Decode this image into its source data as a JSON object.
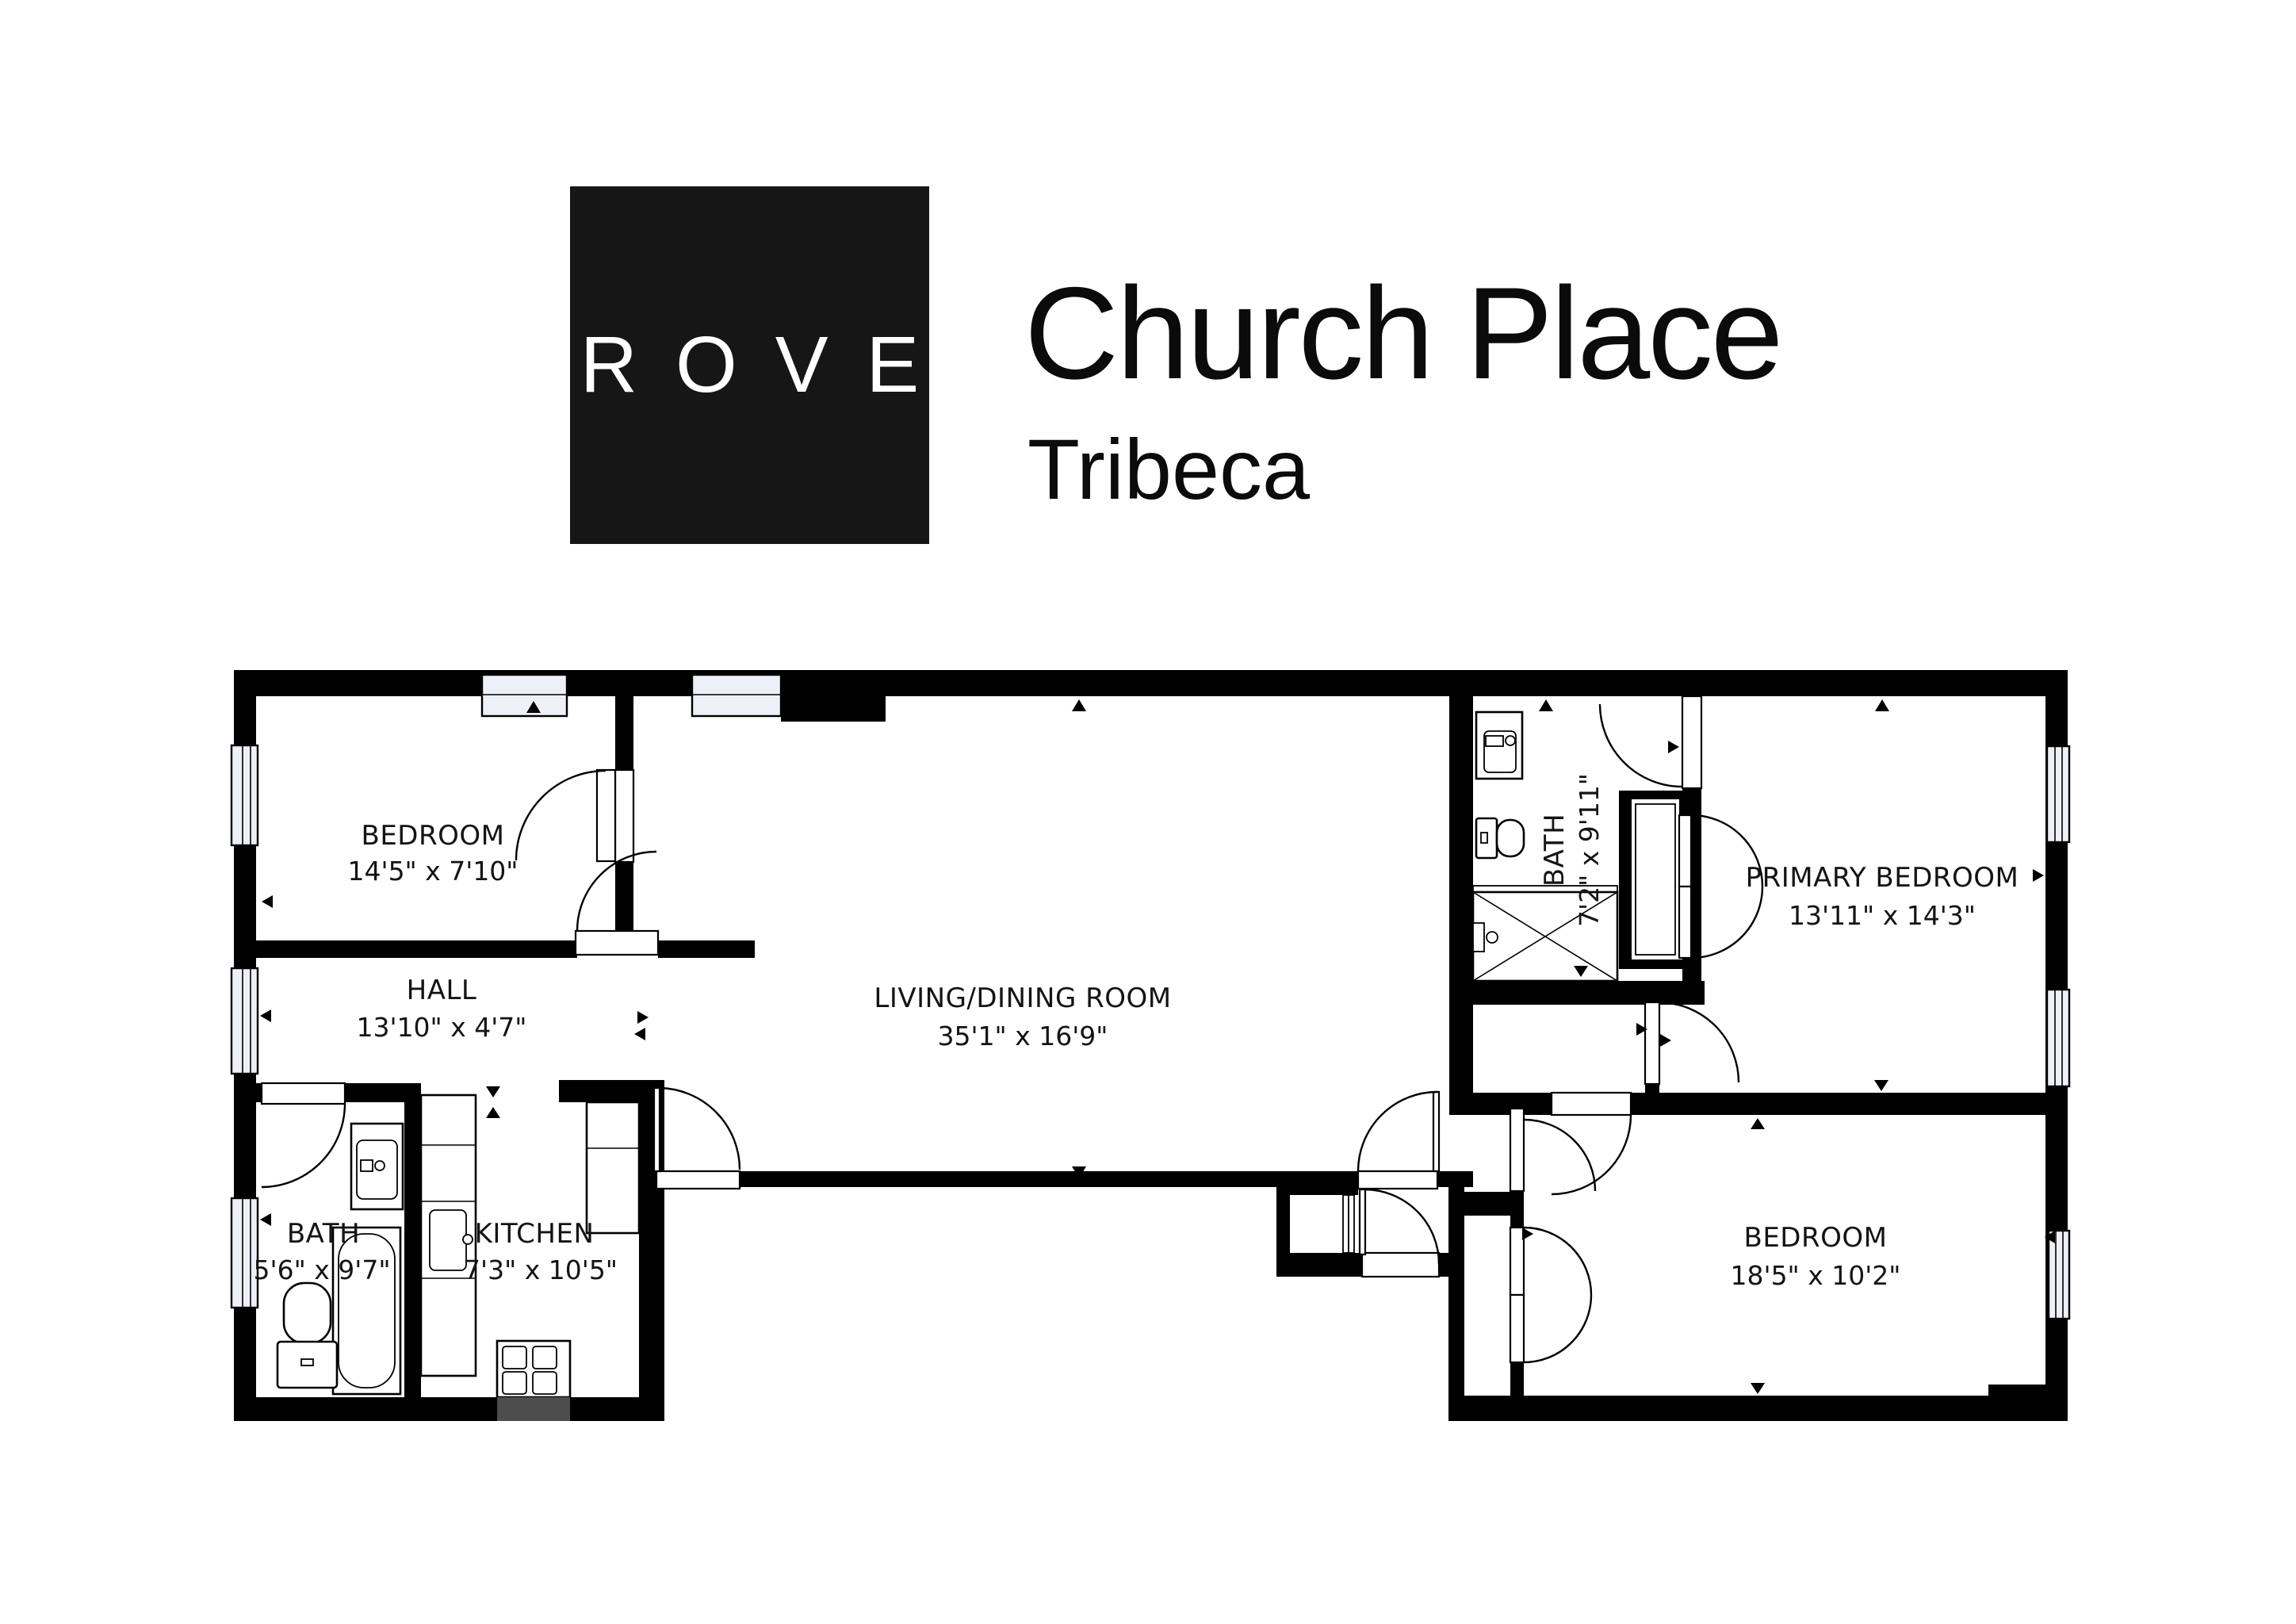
{
  "header": {
    "brand": "ROVE",
    "title": "Church Place",
    "subtitle": "Tribeca"
  },
  "plan": {
    "rooms": [
      {
        "id": "bedroom-top-left",
        "name": "BEDROOM",
        "dims": "14'5\" x 7'10\""
      },
      {
        "id": "hall",
        "name": "HALL",
        "dims": "13'10\" x 4'7\""
      },
      {
        "id": "living-dining",
        "name": "LIVING/DINING ROOM",
        "dims": "35'1\" x 16'9\""
      },
      {
        "id": "bath-right",
        "name": "BATH",
        "dims": "7'2\" x 9'11\""
      },
      {
        "id": "primary-bedroom",
        "name": "PRIMARY BEDROOM",
        "dims": "13'11\" x 14'3\""
      },
      {
        "id": "bath-left",
        "name": "BATH",
        "dims": "5'6\" x 9'7\""
      },
      {
        "id": "kitchen",
        "name": "KITCHEN",
        "dims": "7'3\" x 10'5\""
      },
      {
        "id": "bedroom-bottom-right",
        "name": "BEDROOM",
        "dims": "18'5\" x 10'2\""
      }
    ]
  },
  "colors": {
    "wall": "#000000",
    "background": "#ffffff",
    "logo_background": "#161616",
    "logo_text": "#ffffff",
    "window_fill": "#eef0f8",
    "label_text": "#141414"
  }
}
